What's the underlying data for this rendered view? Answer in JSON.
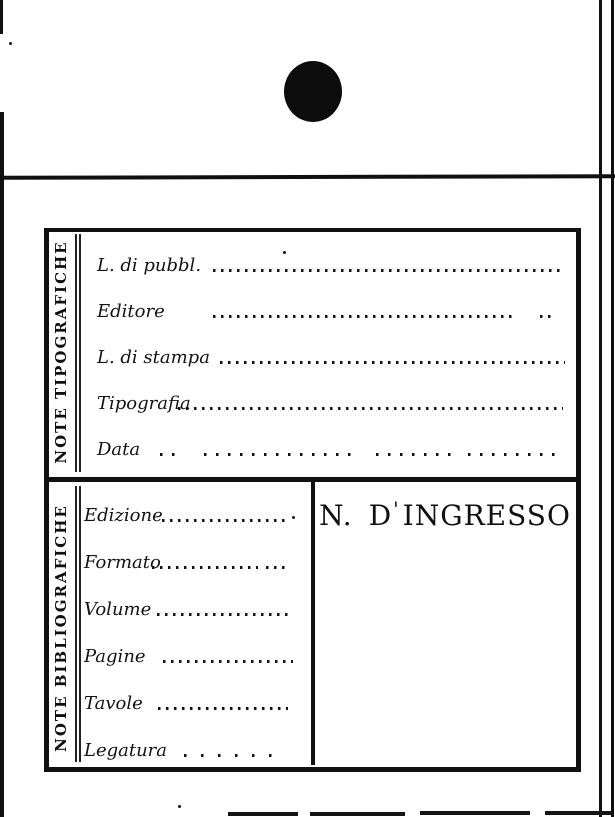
{
  "colors": {
    "ink": "#121212",
    "paper": "#ffffff"
  },
  "card": {
    "punch_hole_icon": "punch-hole",
    "typographic_section": {
      "title": "NOTE TIPOGRAFICHE",
      "fields": [
        {
          "label": "L. di pubbl."
        },
        {
          "label": "Editore"
        },
        {
          "label": "L. di stampa"
        },
        {
          "label": "Tipografia"
        },
        {
          "label": "Data"
        }
      ]
    },
    "bibliographic_section": {
      "title": "NOTE BIBLIOGRAFICHE",
      "fields": [
        {
          "label": "Edizione"
        },
        {
          "label": "Formato"
        },
        {
          "label": "Volume"
        },
        {
          "label": "Pagine"
        },
        {
          "label": "Tavole"
        },
        {
          "label": "Legatura"
        }
      ],
      "accession_panel": {
        "n_label": "N.",
        "d_label": "D",
        "apostrophe": "'",
        "word": "INGRESSO"
      }
    }
  }
}
